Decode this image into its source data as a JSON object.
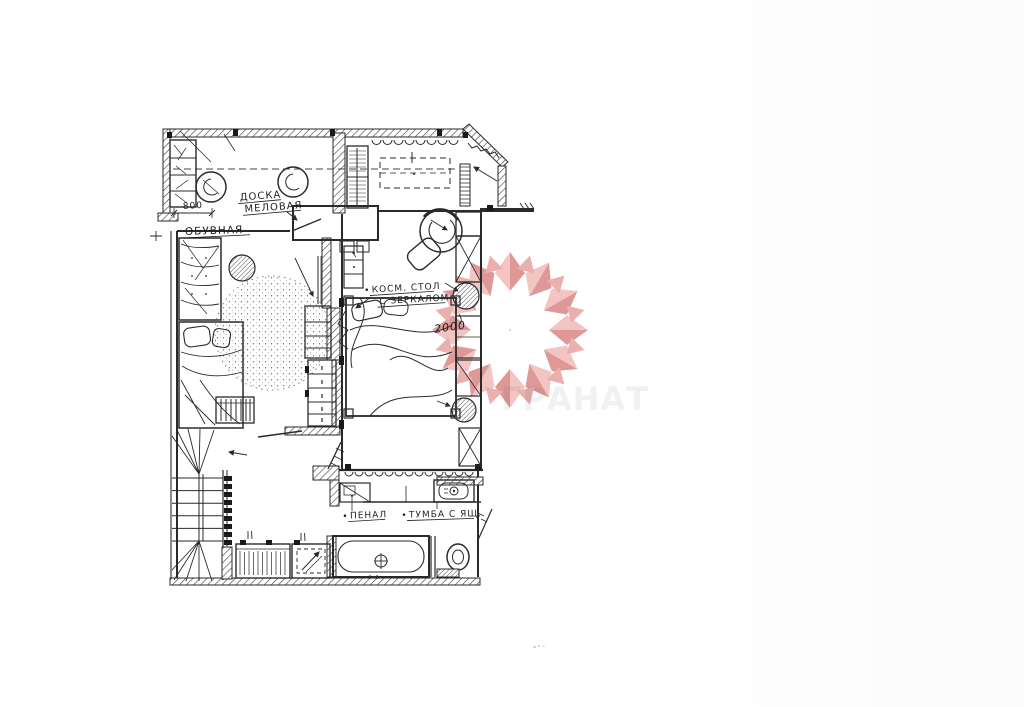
{
  "page": {
    "background": "#ffffff",
    "ink_color": "#2a2a2a",
    "description": "Hand-drawn interior floor plan sketch with red gem watermark"
  },
  "plan": {
    "labels": {
      "chalkboard_line1": "ДОСКА",
      "chalkboard_line2": "МЕЛОВАЯ",
      "room_name": "ОБУВНАЯ",
      "cosmetic_line1": "КОСМ. СТОЛ",
      "cosmetic_line2": "С ЗЕРКАЛОМ",
      "penal": "ПЕНАЛ",
      "tumba": "ТУМБА С ЯЩ."
    },
    "dimensions": {
      "wardrobe_width": "800",
      "bed_length": "2000"
    }
  },
  "watermark": {
    "brand_text": "ГРАНАТ",
    "petal_dark": "#d57c7a",
    "petal_light": "#efb5b3",
    "petal_mid": "#e49a98"
  }
}
